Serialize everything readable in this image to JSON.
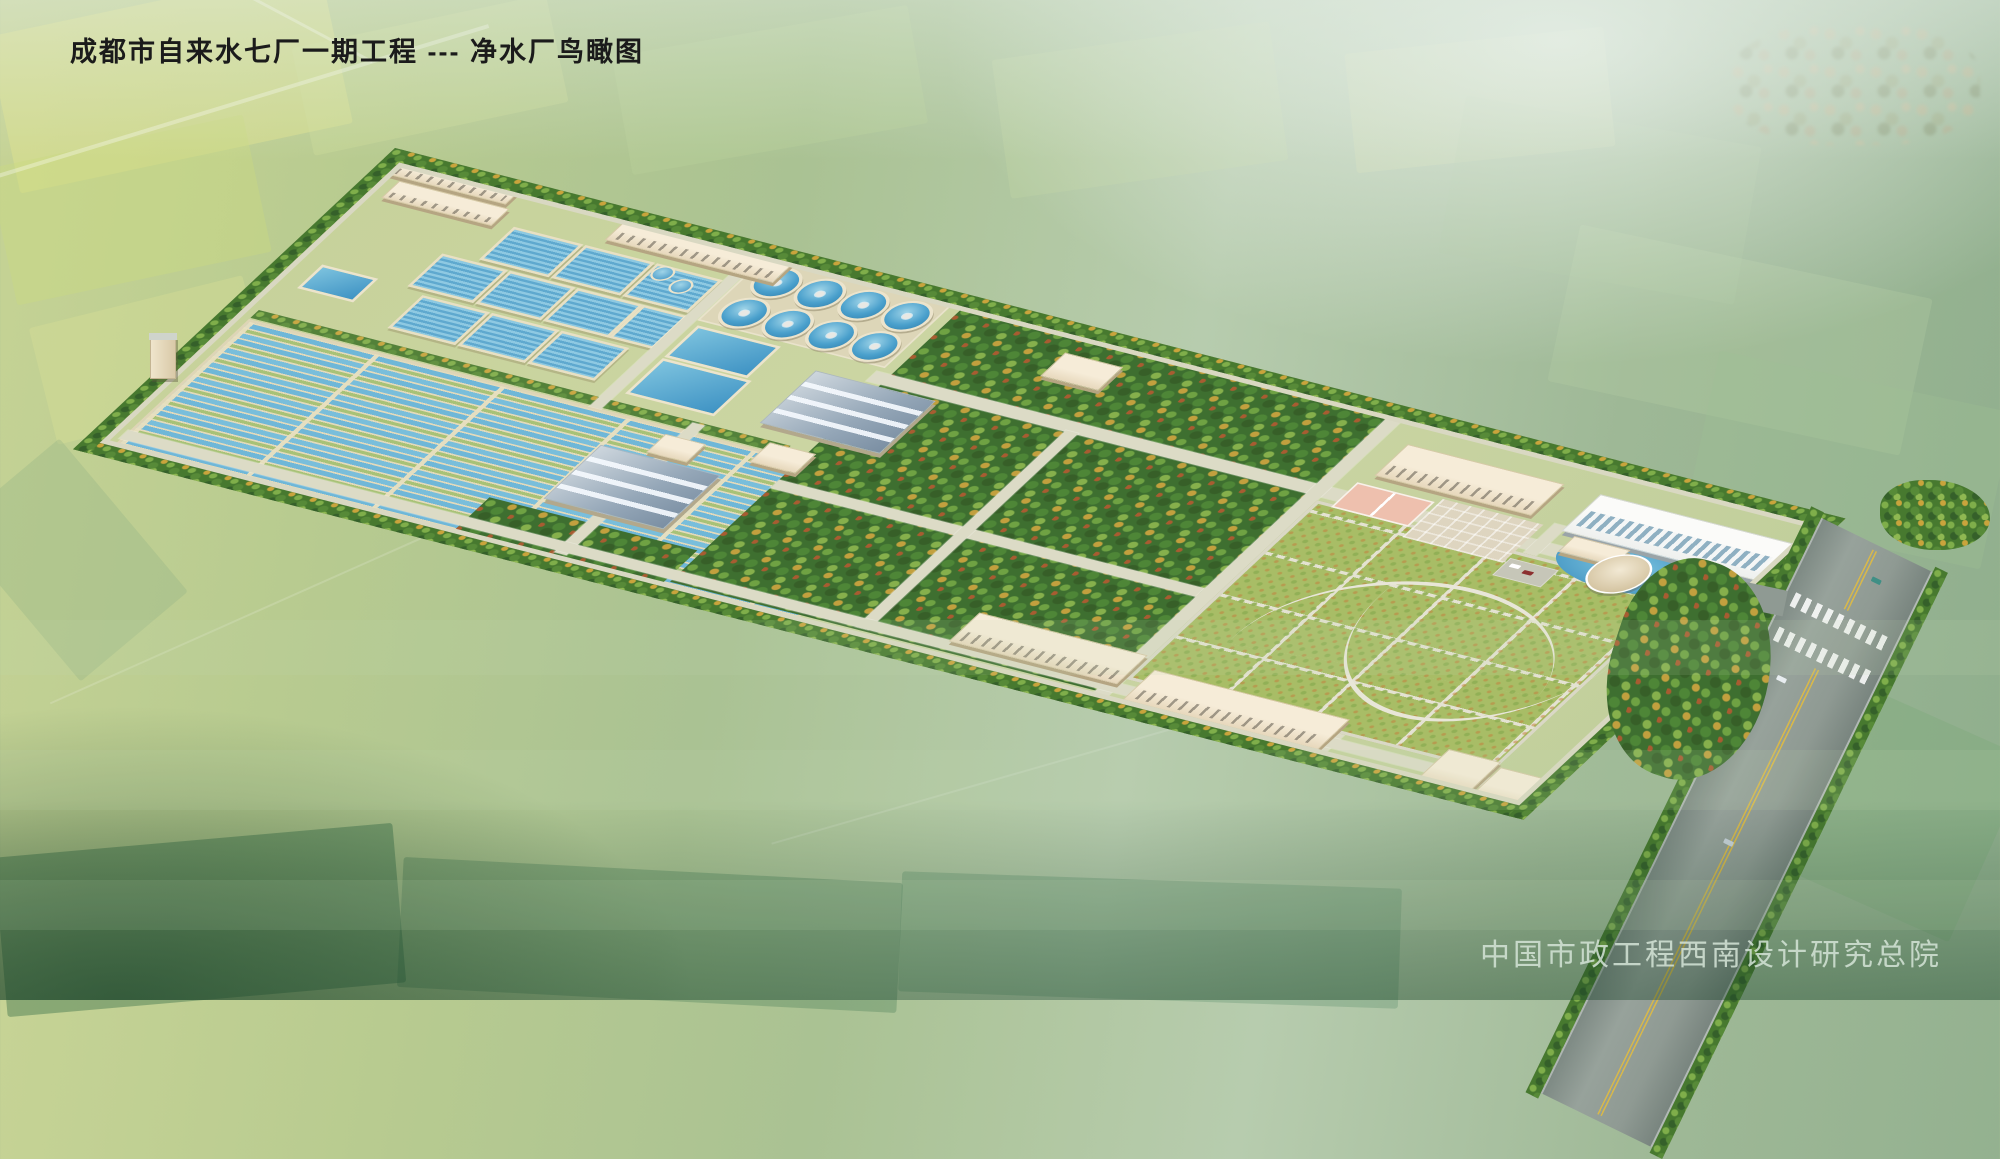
{
  "header": {
    "title": "成都市自来水七厂一期工程 --- 净水厂鸟瞰图"
  },
  "footer": {
    "credit": "中国市政工程西南设计研究总院"
  },
  "scene": {
    "type": "aerial architectural rendering (bird's-eye perspective)",
    "facility": "water purification plant site surrounded by farmland",
    "elements": {
      "circular_clarifiers": 8,
      "small_round_tanks": 2,
      "blue_roofed_workshops": 2,
      "filter_basin_blocks": 10,
      "open_water_pools": 3,
      "long_sedimentation_channels": "striped band on south-west of site",
      "tree_grove_blocks": "dense mixed green/autumn trees in site center",
      "large_lawn": "gridded lawn with curved walking paths on east side",
      "admin_buildings": "two-story office with pink court, white multi-story block, round pavilion with pond",
      "south_service_buildings": 3,
      "highway": "tree-lined road with double yellow centerline, crosswalks and cars at lower right",
      "background": "hazy patchwork fields, distant village at upper right"
    },
    "colors": {
      "water": "#5aaed6",
      "deep_water": "#2e7cab",
      "basin_walkway": "#e6ddbe",
      "tree_green": "#47792f",
      "autumn_yellow": "#c9a43c",
      "autumn_red": "#a85c31",
      "building_beige": "#f0e4cc",
      "blue_roof": "#8fa2b4",
      "lawn": "#a8bd66",
      "site_road": "#dcdbc6",
      "highway_asphalt": "#8f9a93",
      "highway_centerline": "#d8b84a",
      "court_pink": "#eec0ae",
      "title_text": "#1b1b1b",
      "credit_text": "#d5e4d7"
    }
  }
}
